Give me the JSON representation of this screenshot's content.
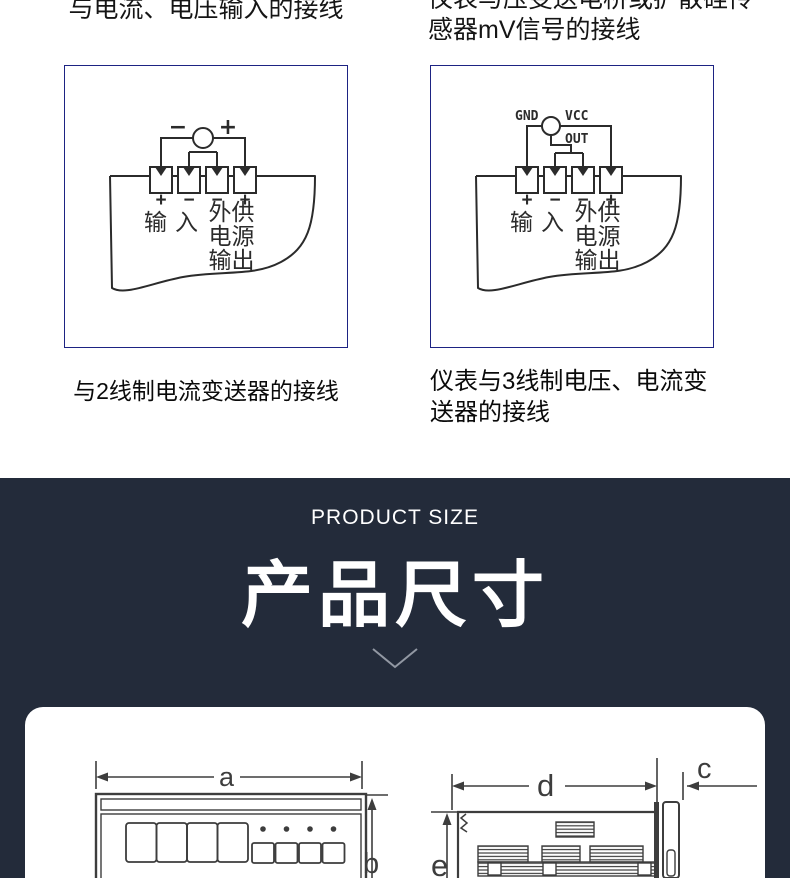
{
  "colors": {
    "diagram_border": "#1d2383",
    "section_bg": "#232b3a",
    "ink": "#2b2b2b",
    "chevron": "#9298a3"
  },
  "wiring_section": {
    "header_left": "与电流、电压输入的接线",
    "header_right_line1": "仪表与压变送电桥或扩散硅传",
    "header_right_line2": "感器mV信号的接线",
    "caption_left": "与2线制电流变送器的接线",
    "caption_right_line1": "仪表与3线制电压、电流变",
    "caption_right_line2": "送器的接线",
    "diagram_left": {
      "minus": "−",
      "plus": "+",
      "polarity": [
        "+",
        "−",
        "−",
        "+"
      ],
      "label_io": "输入",
      "label_col_a": "外电输",
      "label_col_b": "供源出"
    },
    "diagram_right": {
      "gnd": "GND",
      "vcc": "VCC",
      "out": "OUT",
      "polarity": [
        "+",
        "−",
        "−",
        "+"
      ],
      "label_io": "输入",
      "label_col_a": "外电输",
      "label_col_b": "供源出"
    }
  },
  "size_section": {
    "eyebrow": "PRODUCT SIZE",
    "title": "产品尺寸",
    "chevron_icon": "chevron-down",
    "dim_a": "a",
    "dim_b": "b",
    "dim_c": "c",
    "dim_d": "d",
    "dim_e": "e"
  }
}
